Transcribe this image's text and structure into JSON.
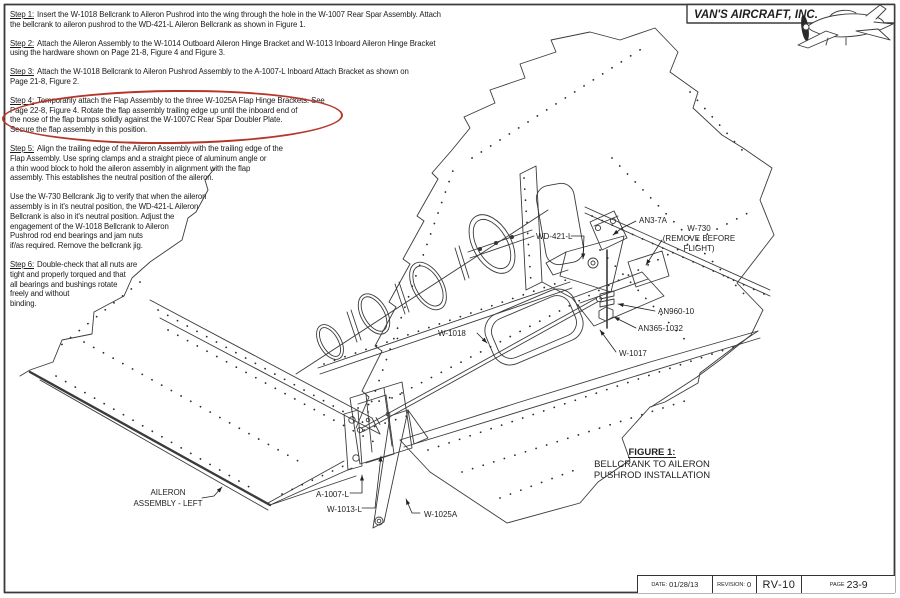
{
  "header": {
    "company": "VAN'S AIRCRAFT, INC."
  },
  "steps": [
    {
      "label": "Step 1:",
      "lines": [
        "Insert the W-1018 Bellcrank to Aileron Pushrod into the wing through the hole in the W-1007 Rear Spar Assembly. Attach",
        "the bellcrank to aileron pushrod to the WD-421-L Aileron Bellcrank as shown in Figure 1."
      ]
    },
    {
      "label": "Step 2:",
      "lines": [
        "Attach the Aileron Assembly to the W-1014 Outboard Aileron Hinge Bracket and W-1013 Inboard Aileron Hinge Bracket",
        "using the hardware shown on Page 21-8, Figure 4 and Figure 3."
      ]
    },
    {
      "label": "Step 3:",
      "lines": [
        "Attach the W-1018 Bellcrank to Aileron Pushrod Assembly to the A-1007-L Inboard Attach Bracket as shown on",
        "Page 21-8, Figure 2."
      ]
    },
    {
      "label": "Step 4:",
      "lines": [
        "Temporarily attach the Flap Assembly to the three W-1025A Flap Hinge Brackets. See",
        "Page 22-8, Figure 4. Rotate the flap assembly trailing edge up until the inboard end of",
        "the nose of the flap bumps solidly against the W-1007C Rear Spar Doubler Plate.",
        "Secure the flap assembly in this position."
      ]
    },
    {
      "label": "Step 5:",
      "lines": [
        "Align the trailing edge of the Aileron Assembly with the trailing edge of the",
        "Flap Assembly. Use spring clamps and a straight piece of aluminum angle or",
        "a thin wood block to hold the aileron assembly in alignment with the flap",
        "assembly. This establishes the neutral position of the aileron."
      ]
    }
  ],
  "note": {
    "lines": [
      "Use the W-730 Bellcrank Jig to verify that when the aileron",
      "assembly is in it's neutral position, the WD-421-L Aileron",
      "Bellcrank is also in it's neutral position. Adjust the",
      "engagement of the W-1018 Bellcrank to Aileron",
      "Pushrod rod end bearings and jam nuts",
      "if/as required. Remove the bellcrank jig."
    ]
  },
  "step6": {
    "label": "Step 6:",
    "lines": [
      "Double-check that all nuts are",
      "tight and properly torqued and that",
      "all bearings and bushings rotate",
      "freely and without",
      "binding."
    ]
  },
  "callouts": {
    "wd421": "WD-421-L",
    "an37a": "AN3-7A",
    "w730_1": "W-730",
    "w730_2": "(REMOVE BEFORE",
    "w730_3": "FLIGHT)",
    "an960": "AN960-10",
    "an365": "AN365-1032",
    "w1017": "W-1017",
    "w1018": "W-1018",
    "aileron1": "AILERON",
    "aileron2": "ASSEMBLY - LEFT",
    "a1007": "A-1007-L",
    "w1013": "W-1013-L",
    "w1025": "W-1025A"
  },
  "figure": {
    "label": "FIGURE 1:",
    "line1": "BELLCRANK TO AILERON",
    "line2": "PUSHROD INSTALLATION"
  },
  "titleblock": {
    "date_label": "DATE:",
    "date": "01/28/13",
    "rev_label": "REVISION:",
    "rev": "0",
    "model": "RV-10",
    "page_label": "PAGE",
    "page": "23-9"
  },
  "colors": {
    "highlight": "#b5372b",
    "line": "#3b3b3b"
  }
}
